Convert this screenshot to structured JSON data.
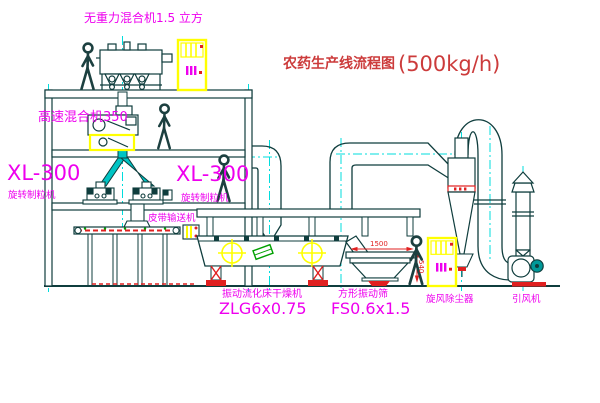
{
  "title": {
    "text": "农药生产线流程图",
    "capacity": "(500kg/h)"
  },
  "equipment": {
    "gravity_mixer_label": "无重力混合机1.5 立方",
    "high_speed_mixer_label": "高速混合机350",
    "granulator_left": {
      "model": "XL-300",
      "name": "旋转制粒机"
    },
    "granulator_right": {
      "model": "XL-300",
      "name": "旋转制粒机"
    },
    "belt_conveyor_label": "皮带输送机",
    "dryer": {
      "name": "振动流化床干燥机",
      "model": "ZLG6x0.75"
    },
    "screen": {
      "name": "方形振动筛",
      "model": "FS0.6x1.5"
    },
    "cyclone_label": "旋风除尘器",
    "fan_label": "引风机"
  },
  "dimensions": {
    "screen_length": "1500",
    "screen_height": "540"
  },
  "colors": {
    "line": "#0f3d3d",
    "magenta": "#ee00ee",
    "red": "#e02020",
    "title_red": "#cc3b3b",
    "cyan": "#00dddd",
    "yellow": "#ffff00",
    "teal_fill": "#00c4c4",
    "green": "#00a000"
  }
}
